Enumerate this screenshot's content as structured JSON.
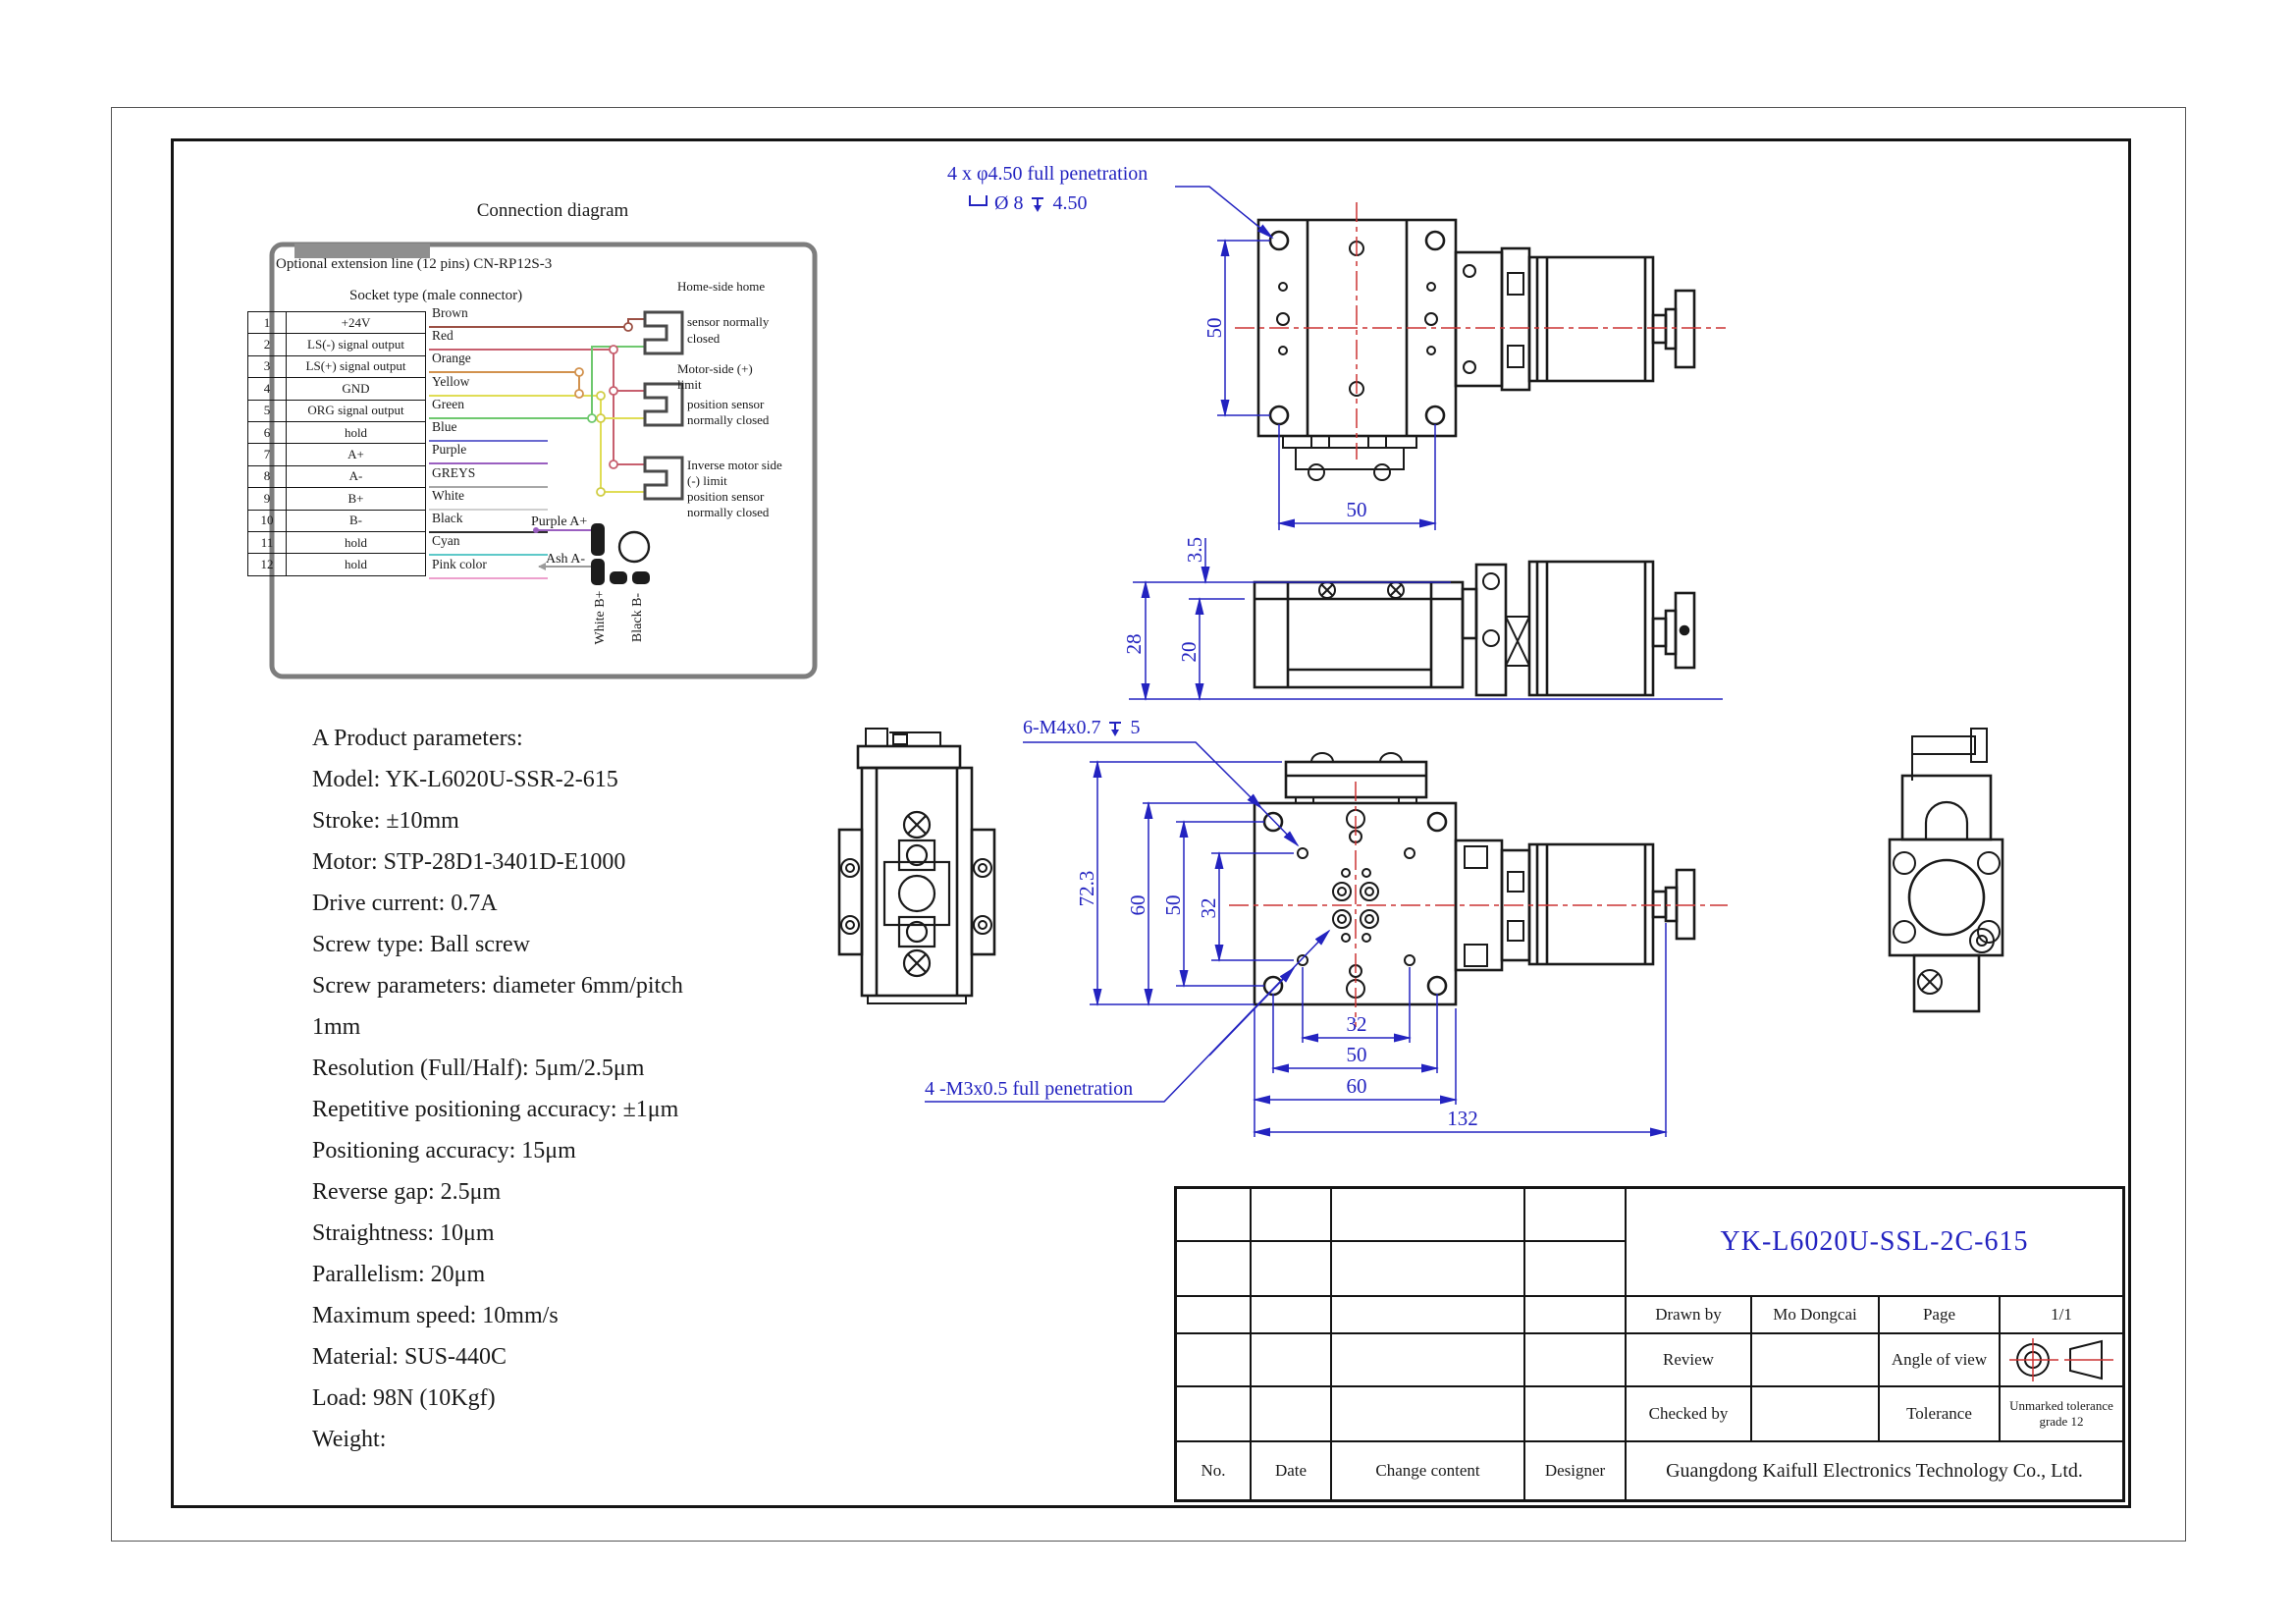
{
  "colors": {
    "accent_blue": "#2323c0",
    "centerline_red": "#cc3333",
    "line_black": "#1a1a1a",
    "box_gray": "#7d7d7d"
  },
  "connection_diagram": {
    "title": "Connection diagram",
    "optional_line": "Optional extension line (12 pins) CN-RP12S-3",
    "socket_type": "Socket type (male connector)",
    "pins": [
      {
        "no": "1",
        "signal": "+24V"
      },
      {
        "no": "2",
        "signal": "LS(-) signal output"
      },
      {
        "no": "3",
        "signal": "LS(+) signal output"
      },
      {
        "no": "4",
        "signal": "GND"
      },
      {
        "no": "5",
        "signal": "ORG signal output"
      },
      {
        "no": "6",
        "signal": "hold"
      },
      {
        "no": "7",
        "signal": "A+"
      },
      {
        "no": "8",
        "signal": "A-"
      },
      {
        "no": "9",
        "signal": "B+"
      },
      {
        "no": "10",
        "signal": "B-"
      },
      {
        "no": "11",
        "signal": "hold"
      },
      {
        "no": "12",
        "signal": "hold"
      }
    ],
    "wires": [
      {
        "label": "Brown",
        "color": "#9b5044"
      },
      {
        "label": "Red",
        "color": "#c75f6e"
      },
      {
        "label": "Orange",
        "color": "#d2924e"
      },
      {
        "label": "Yellow",
        "color": "#e0dd55"
      },
      {
        "label": "Green",
        "color": "#6ec86e"
      },
      {
        "label": "Blue",
        "color": "#6a6ad0"
      },
      {
        "label": "Purple",
        "color": "#9a5fc0"
      },
      {
        "label": "GREYS",
        "color": "#a8a8a8"
      },
      {
        "label": "White",
        "color": "#cfcfcf"
      },
      {
        "label": "Black",
        "color": "#2e2e2e"
      },
      {
        "label": "Cyan",
        "color": "#5ec9c9"
      },
      {
        "label": "Pink color",
        "color": "#eda0cd"
      }
    ],
    "sensor1_lines": [
      "Home-side home",
      "sensor normally",
      "closed"
    ],
    "sensor2_lines": [
      "Motor-side (+)",
      "limit",
      "position sensor",
      "normally closed"
    ],
    "sensor3_lines": [
      "Inverse motor side",
      "(-) limit",
      "position sensor",
      "normally closed"
    ],
    "motor_labels": {
      "a_plus": "Purple A+",
      "a_minus": "Ash A-",
      "b_plus": "White B+",
      "b_minus": "Black B-"
    }
  },
  "parameters": {
    "lines": [
      "A Product parameters:",
      "Model: YK-L6020U-SSR-2-615",
      "Stroke: ±10mm",
      "Motor: STP-28D1-3401D-E1000",
      "Drive current: 0.7A",
      "Screw type: Ball screw",
      "Screw parameters: diameter 6mm/pitch",
      "1mm",
      "Resolution (Full/Half): 5μm/2.5μm",
      "Repetitive positioning accuracy: ±1μm",
      "Positioning accuracy: 15μm",
      "Reverse gap: 2.5μm",
      "Straightness: 10μm",
      "Parallelism: 20μm",
      "Maximum speed: 10mm/s",
      "Material: SUS-440C",
      "Load: 98N (10Kgf)",
      "Weight:"
    ]
  },
  "views": {
    "top": {
      "note1": "4 x φ4.50 full penetration",
      "cbore_dia": "Ø 8",
      "cbore_depth": "4.50",
      "dim_v": "50",
      "dim_h": "50"
    },
    "side": {
      "dim_gap": "3.5",
      "dim_height": "28",
      "dim_body": "20"
    },
    "plan": {
      "note_top": "6-M4x0.7",
      "note_top_depth": "5",
      "note_bottom": "4 -M3x0.5 full penetration",
      "dim_left_overall": "72.3",
      "dim_left_plate": "60",
      "dim_left_holes": "50",
      "dim_left_m3": "32",
      "dim_bottom_m3": "32",
      "dim_bottom_holes": "50",
      "dim_bottom_plate": "60",
      "dim_bottom_overall": "132"
    }
  },
  "title_block": {
    "model": "YK-L6020U-SSL-2C-615",
    "drawn_by_label": "Drawn by",
    "drawn_by": "Mo Dongcai",
    "page_label": "Page",
    "page": "1/1",
    "review_label": "Review",
    "angle_of_view_label": "Angle of view",
    "checked_by_label": "Checked by",
    "tolerance_label": "Tolerance",
    "tolerance_value": "Unmarked tolerance grade 12",
    "no_label": "No.",
    "date_label": "Date",
    "change_content_label": "Change content",
    "designer_label": "Designer",
    "company": "Guangdong Kaifull Electronics Technology Co., Ltd."
  }
}
